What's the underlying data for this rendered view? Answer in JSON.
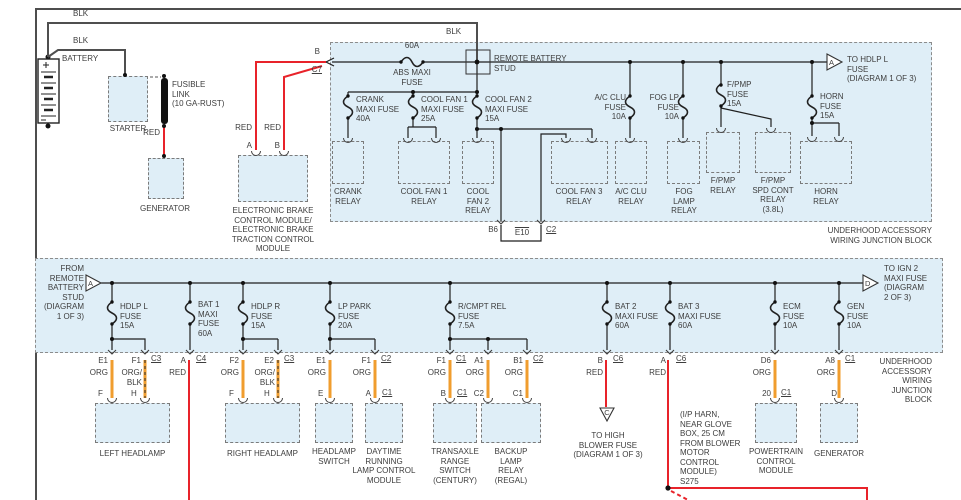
{
  "colors": {
    "red": "#e8232a",
    "orange": "#f09d2e",
    "block_fill": "#dfeef7",
    "wire_black": "#1f1f1f",
    "wire_gray": "#4f4f4f"
  },
  "left": {
    "blk_top": "BLK",
    "blk_mid": "BLK",
    "blk_stud": "BLK",
    "battery": "BATTERY",
    "starter": "STARTER",
    "fusible_link": "FUSIBLE\nLINK\n(10 GA-RUST)",
    "red_label": "RED",
    "generator": "GENERATOR",
    "ebcm_red_a": "RED",
    "ebcm_red_b": "RED",
    "ebcm_pin_a": "A",
    "ebcm_pin_b": "B",
    "pin_b": "B",
    "conn_c7": "C7",
    "ebcm": "ELECTRONIC BRAKE\nCONTROL MODULE/\nELECTRONIC BRAKE\nTRACTION CONTROL\nMODULE"
  },
  "upper": {
    "stud": "REMOTE BATTERY\nSTUD",
    "abs_amp": "60A",
    "abs_label": "ABS MAXI\nFUSE",
    "tri_a": "A",
    "to_hdlp": "TO HDLP L\nFUSE\n(DIAGRAM 1 OF 3)",
    "fuses": [
      {
        "label": "CRANK\nMAXI FUSE\n40A"
      },
      {
        "label": "COOL FAN 1\nMAXI FUSE\n25A"
      },
      {
        "label": "COOL FAN 2\nMAXI FUSE\n15A"
      },
      {
        "label": "A/C CLU\nFUSE\n10A"
      },
      {
        "label": "FOG LP\nFUSE\n10A"
      },
      {
        "label": "F/PMP\nFUSE\n15A"
      },
      {
        "label": "HORN\nFUSE\n15A"
      }
    ],
    "relays": [
      {
        "label": "CRANK\nRELAY"
      },
      {
        "label": "COOL FAN 1\nRELAY"
      },
      {
        "label": "COOL\nFAN 2\nRELAY"
      },
      {
        "label": "COOL FAN 3\nRELAY"
      },
      {
        "label": "A/C CLU\nRELAY"
      },
      {
        "label": "FOG\nLAMP\nRELAY"
      },
      {
        "label": "F/PMP\nRELAY"
      },
      {
        "label": "F/PMP\nSPD CONT\nRELAY\n(3.8L)"
      },
      {
        "label": "HORN\nRELAY"
      }
    ],
    "pin_b6": "B6",
    "pin_e10": "E10",
    "conn_c2": "C2",
    "title": "UNDERHOOD ACCESSORY\nWIRING JUNCTION BLOCK"
  },
  "lower": {
    "from_stud": "FROM\nREMOTE\nBATTERY\nSTUD\n(DIAGRAM\n1 OF 3)",
    "tri_a": "A",
    "tri_d": "D",
    "to_ign2": "TO IGN 2\nMAXI FUSE\n(DIAGRAM\n2 OF 3)",
    "title": "UNDERHOOD\nACCESSORY\nWIRING\nJUNCTION\nBLOCK",
    "fuses": [
      {
        "label": "HDLP L\nFUSE\n15A"
      },
      {
        "label": "BAT 1\nMAXI\nFUSE\n60A"
      },
      {
        "label": "HDLP R\nFUSE\n15A"
      },
      {
        "label": "LP PARK\nFUSE\n20A"
      },
      {
        "label": "R/CMPT REL\nFUSE\n7.5A"
      },
      {
        "label": "BAT 2\nMAXI FUSE\n60A"
      },
      {
        "label": "BAT 3\nMAXI FUSE\n60A"
      },
      {
        "label": "ECM\nFUSE\n10A"
      },
      {
        "label": "GEN\nFUSE\n10A"
      }
    ]
  },
  "pins": [
    {
      "pin": "E1",
      "color": "ORG"
    },
    {
      "pin": "F1",
      "conn": "C3",
      "color": "ORG/\nBLK"
    },
    {
      "pin": "A",
      "conn": "C4",
      "color": "RED"
    },
    {
      "pin": "F2",
      "color": "ORG"
    },
    {
      "pin": "E2",
      "conn": "C3",
      "color": "ORG/\nBLK"
    },
    {
      "pin": "E1",
      "color": "ORG"
    },
    {
      "pin": "F1",
      "conn": "C2",
      "color": "ORG"
    },
    {
      "pin": "F1",
      "conn": "C1",
      "color": "ORG"
    },
    {
      "pin": "A1",
      "color": "ORG"
    },
    {
      "pin": "B1",
      "conn": "C2",
      "color": "ORG"
    },
    {
      "pin": "B",
      "conn": "C6",
      "color": "RED"
    },
    {
      "pin": "A",
      "conn": "C6",
      "color": "RED"
    },
    {
      "pin": "D6",
      "color": "ORG"
    },
    {
      "pin": "A8",
      "conn": "C1",
      "color": "ORG"
    }
  ],
  "dest_pins": [
    {
      "pin": "F"
    },
    {
      "pin": "H"
    },
    {
      "pin": "F"
    },
    {
      "pin": "H"
    },
    {
      "pin": "E"
    },
    {
      "pin": "A",
      "conn": "C1"
    },
    {
      "pin": "B",
      "conn": "C1"
    },
    {
      "pin": "C2"
    },
    {
      "pin": "C1"
    },
    {
      "pin": "20",
      "conn": "C1"
    },
    {
      "pin": "D"
    }
  ],
  "components": [
    {
      "label": "LEFT HEADLAMP"
    },
    {
      "label": "RIGHT HEADLAMP"
    },
    {
      "label": "HEADLAMP\nSWITCH"
    },
    {
      "label": "DAYTIME\nRUNNING\nLAMP CONTROL\nMODULE"
    },
    {
      "label": "TRANSAXLE\nRANGE\nSWITCH\n(CENTURY)"
    },
    {
      "label": "BACKUP\nLAMP\nRELAY\n(REGAL)"
    },
    {
      "label": "POWERTRAIN\nCONTROL\nMODULE"
    },
    {
      "label": "GENERATOR"
    }
  ],
  "notes": {
    "tri_c": "C",
    "to_high_blower": "TO HIGH\nBLOWER FUSE\n(DIAGRAM 1 OF 3)",
    "splice": "(I/P HARN,\nNEAR GLOVE\nBOX, 25 CM\nFROM BLOWER\nMOTOR\nCONTROL\nMODULE)\nS275"
  }
}
